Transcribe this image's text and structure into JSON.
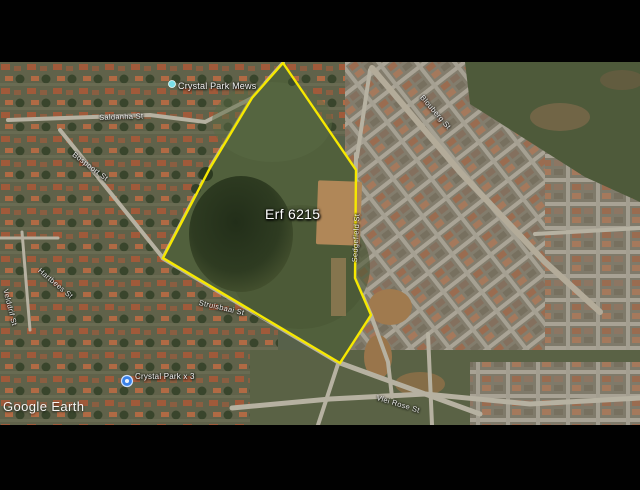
{
  "parcel": {
    "label": "Erf 6215"
  },
  "labels": {
    "erf": "Erf 6215",
    "crystal_park_mews": "Crystal Park Mews",
    "saldanha": "Saldanha St",
    "crystal_park_x3": "Crystal Park x 3",
    "google_earth": "Google Earth",
    "street_left_diag": "Bospoort St",
    "street_left_mid": "Hartbees St",
    "street_left_vert": "Velddrif St",
    "street_boundary_vert": "Sedgefield St",
    "street_right_diag": "Blouberg St",
    "street_bottom_mid": "Struisbaai St",
    "street_bottom_right": "Vlei Rose St"
  },
  "colors": {
    "boundary": "#f6e800",
    "marker_blue": "#3b82e8",
    "marker_teal": "#7adfe8",
    "label_text": "#ffffff"
  }
}
